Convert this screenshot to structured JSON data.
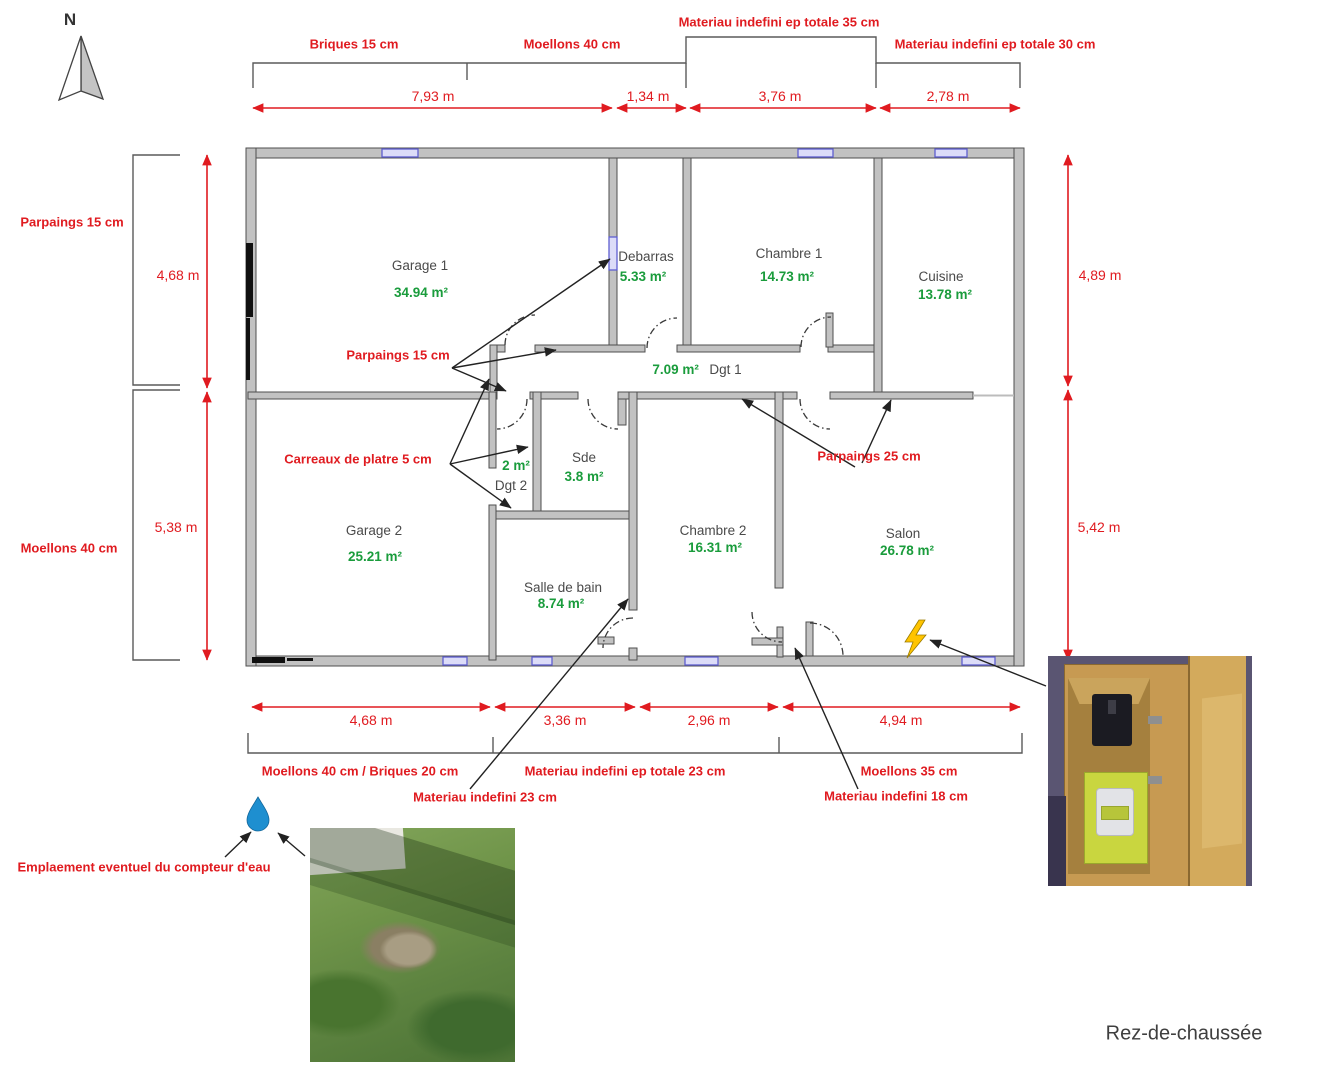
{
  "compass": {
    "letter": "N"
  },
  "top": {
    "bracket_labels": {
      "briques": "Briques 15 cm",
      "moellons": "Moellons 40 cm",
      "mat35": "Materiau indefini ep totale 35 cm",
      "mat30": "Materiau indefini ep totale 30 cm"
    },
    "dims": [
      "7,93 m",
      "1,34 m",
      "3,76 m",
      "2,78 m"
    ]
  },
  "left": {
    "labels": {
      "parpaings": "Parpaings 15 cm",
      "moellons": "Moellons 40 cm"
    },
    "dims": [
      "4,68 m",
      "5,38 m"
    ]
  },
  "right": {
    "dims": [
      "4,89 m",
      "5,42 m"
    ]
  },
  "bottom": {
    "dims": [
      "4,68 m",
      "3,36 m",
      "2,96 m",
      "4,94 m"
    ],
    "bracket_labels": {
      "moellons_briques": "Moellons 40 cm / Briques 20 cm",
      "mat23_totale": "Materiau indefini ep totale 23 cm",
      "moellons35": "Moellons 35 cm"
    },
    "leader_labels": {
      "mat23": "Materiau indefini 23 cm",
      "mat18": "Materiau indefini 18 cm"
    }
  },
  "rooms": {
    "garage1": {
      "name": "Garage 1",
      "area": "34.94 m²"
    },
    "debarras": {
      "name": "Debarras",
      "area": "5.33 m²"
    },
    "chambre1": {
      "name": "Chambre 1",
      "area": "14.73 m²"
    },
    "cuisine": {
      "name": "Cuisine",
      "area": "13.78 m²"
    },
    "dgt1": {
      "name": "Dgt 1",
      "area": "7.09 m²"
    },
    "dgt2": {
      "name": "Dgt 2",
      "area": "2 m²"
    },
    "sde": {
      "name": "Sde",
      "area": "3.8 m²"
    },
    "garage2": {
      "name": "Garage 2",
      "area": "25.21 m²"
    },
    "salle_de_bain": {
      "name": "Salle de bain",
      "area": "8.74 m²"
    },
    "chambre2": {
      "name": "Chambre 2",
      "area": "16.31 m²"
    },
    "salon": {
      "name": "Salon",
      "area": "26.78 m²"
    }
  },
  "wall_annotations": {
    "parpaings15": "Parpaings 15 cm",
    "carreaux": "Carreaux de platre 5 cm",
    "parpaings25": "Parpaings 25 cm"
  },
  "water_meter": {
    "label": "Emplaement eventuel du compteur d'eau"
  },
  "footer": {
    "floor": "Rez-de-chaussée"
  },
  "colors": {
    "annotation_red": "#e01b20",
    "area_green": "#1a9c3c",
    "wall_gray": "#c2c2c2",
    "wall_edge": "#4f4f4f",
    "window_blue": "#5f5fd0",
    "drop_blue": "#1e8fd0",
    "bolt_yellow": "#ffc400"
  }
}
